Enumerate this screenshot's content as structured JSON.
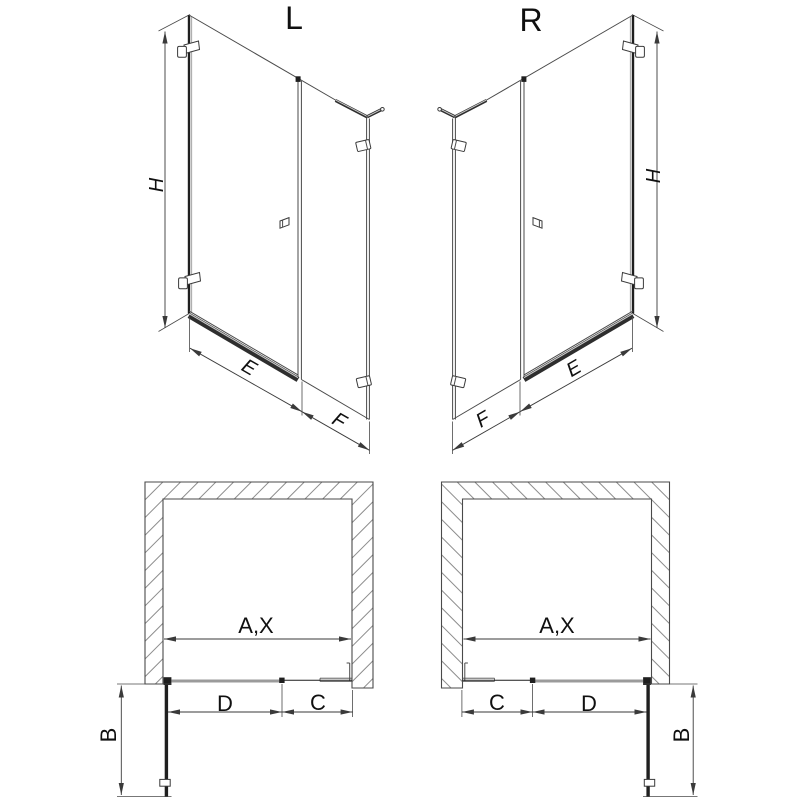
{
  "drawing": {
    "title_left": "L",
    "title_right": "R",
    "front_left": {
      "height": "H",
      "door_width": "E",
      "side_panel_width": "F"
    },
    "front_right": {
      "height": "H",
      "door_width": "E",
      "side_panel_width": "F"
    },
    "plan_left": {
      "opening_width": "A,X",
      "door_width": "D",
      "side_panel_width": "C",
      "open_door_depth": "B"
    },
    "plan_right": {
      "opening_width": "A,X",
      "door_width": "D",
      "side_panel_width": "C",
      "open_door_depth": "B"
    }
  },
  "colors": {
    "background": "#ffffff",
    "structure_line": "#4a4a4a",
    "dark_line": "#1f1f1f",
    "dimension_line": "#3a3a3a",
    "hatch_line": "#8c8c8c",
    "rail_gray": "#9b9b9b",
    "text": "#101010"
  }
}
